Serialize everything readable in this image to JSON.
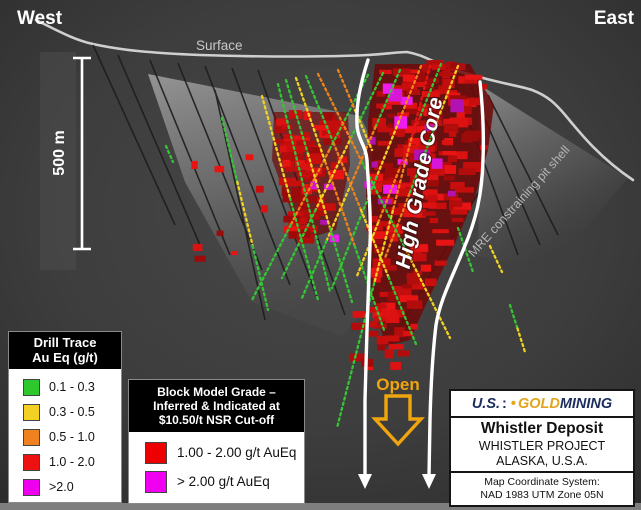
{
  "section": {
    "west_label": "West",
    "east_label": "East",
    "surface_label": "Surface",
    "scale_label": "500 m",
    "high_grade_core_label": "High Grade Core",
    "pit_shell_label": "MRE constraining pit shell",
    "open_label": "Open"
  },
  "drill_legend": {
    "title_line1": "Drill Trace",
    "title_line2": "Au Eq (g/t)",
    "items": [
      {
        "color": "#2ec82e",
        "label": "0.1 - 0.3"
      },
      {
        "color": "#f2d124",
        "label": "0.3 - 0.5"
      },
      {
        "color": "#f0811f",
        "label": "0.5 - 1.0"
      },
      {
        "color": "#ee1111",
        "label": "1.0 - 2.0"
      },
      {
        "color": "#ee00ee",
        "label": ">2.0"
      }
    ]
  },
  "block_legend": {
    "title_line1": "Block Model Grade –",
    "title_line2": "Inferred & Indicated at",
    "title_line3": "$10.50/t NSR Cut-off",
    "items": [
      {
        "color": "#ee0000",
        "label": "1.00 - 2.00 g/t AuEq"
      },
      {
        "color": "#f000f0",
        "label": "> 2.00 g/t AuEq"
      }
    ]
  },
  "info_box": {
    "logo_part1": "U.S.",
    "logo_sep_navy": ":",
    "logo_sep_gold": "•",
    "logo_part2": "GOLD",
    "logo_part3": "MINING",
    "deposit": "Whistler Deposit",
    "project": "WHISTLER PROJECT",
    "location": "ALASKA, U.S.A.",
    "coord_line1": "Map Coordinate System:",
    "coord_line2": "NAD 1983 UTM Zone 05N"
  },
  "colors": {
    "background": "#3d3d3d",
    "surface_line": "#cfcfcf",
    "core_outline": "#ffffff",
    "open_gold": "#f0a50f",
    "logo_navy": "#1d2e5e",
    "logo_gold": "#e2a51c",
    "trace_palette": {
      "g": "#35c535",
      "y": "#f2d21f",
      "o": "#f08219",
      "r": "#e51515",
      "m": "#ee22ee"
    },
    "block_reds": [
      "#9c0a0a",
      "#b30c0c",
      "#c90e0e",
      "#dc1111",
      "#e81414",
      "#c40d0d"
    ],
    "block_magentas": [
      "#d816d8",
      "#ee1cee",
      "#b312b3"
    ]
  }
}
